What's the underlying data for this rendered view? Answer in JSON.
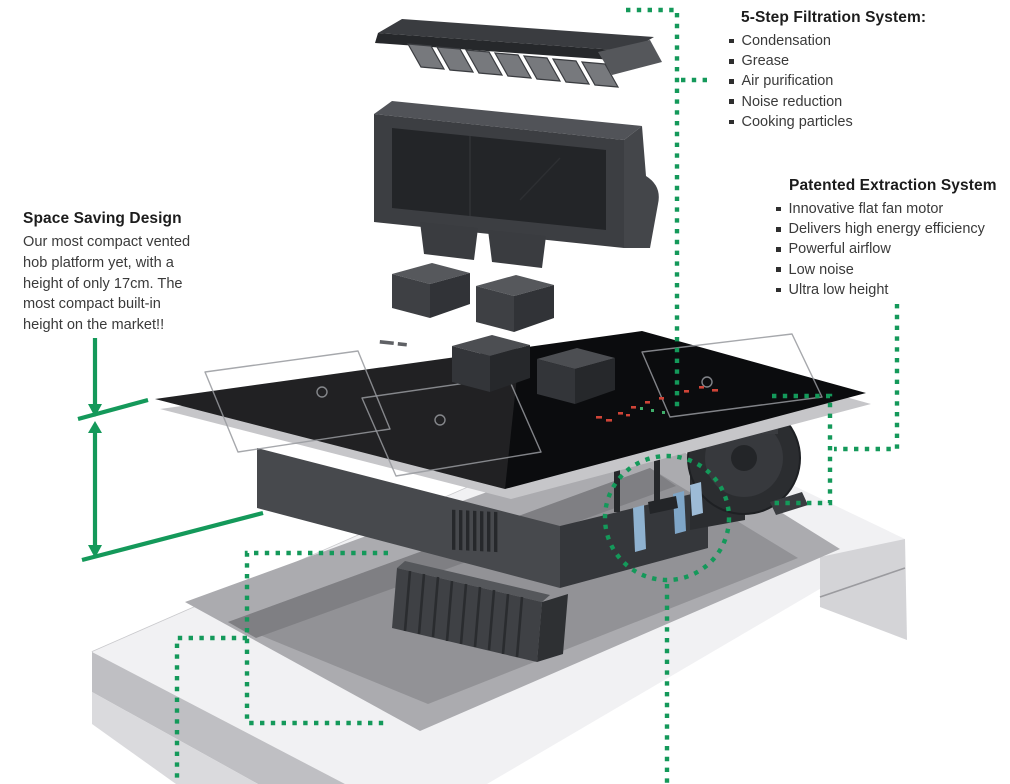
{
  "annotations": {
    "filtration": {
      "title": "5-Step Filtration System:",
      "items": [
        "Condensation",
        "Grease",
        "Air purification",
        "Noise reduction",
        "Cooking particles"
      ]
    },
    "extraction": {
      "title": "Patented Extraction System",
      "items": [
        "Innovative flat fan motor",
        "Delivers high energy efficiency",
        "Powerful airflow",
        "Low noise",
        "Ultra low height"
      ]
    },
    "space_saving": {
      "title": "Space Saving Design",
      "lines": [
        "Our most compact vented",
        "hob platform yet, with a",
        "height of only 17cm. The",
        "most compact built-in",
        "height on the market!!"
      ]
    }
  },
  "colors": {
    "accent_green": "#14995a",
    "glass_black": "#0b0c0e",
    "unit_gray": "#47494d",
    "worktop_gray": "#f1f1f3",
    "cutout_gray": "#a9a9ad",
    "blue_part": "#85abc9",
    "led_red": "#cf4437"
  }
}
